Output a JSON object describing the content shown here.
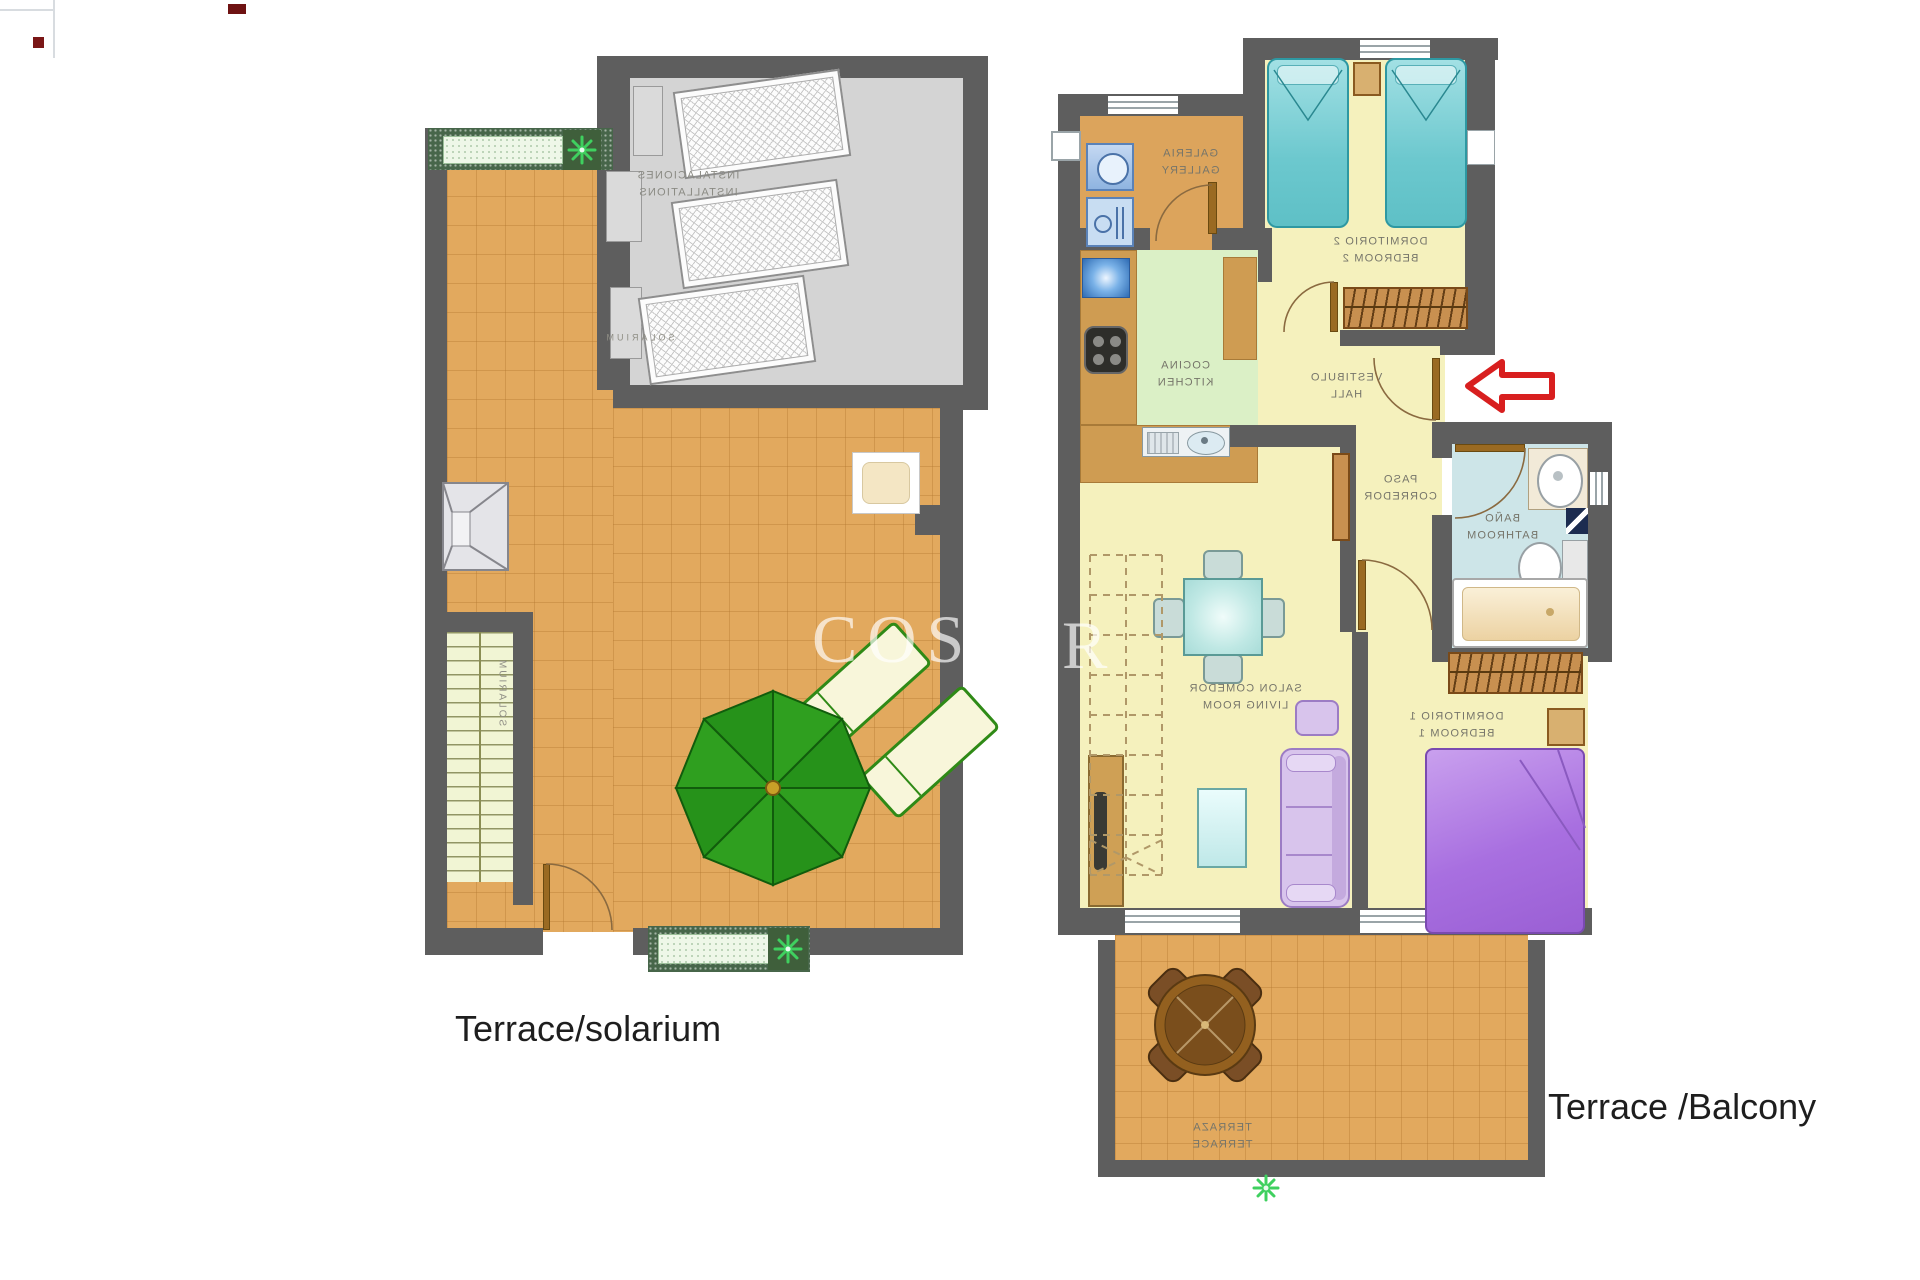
{
  "image": {
    "kind": "real-estate floor plan brochure",
    "background": "#ffffff"
  },
  "watermark": {
    "text": "COST",
    "partial_letter": "R"
  },
  "captions": {
    "left": "Terrace/solarium",
    "right": "Terrace /Balcony"
  },
  "plans": {
    "left": {
      "labels": {
        "installations_es": "INSTALACIONES",
        "installations_en": "INSTALLATIONS",
        "solarium_top": "SOLARIUM",
        "solarium_side": "SOLARIUM"
      }
    },
    "right": {
      "rooms": [
        {
          "id": "gallery",
          "es": "GALERIA",
          "en": "GALLERY"
        },
        {
          "id": "bedroom-2",
          "es": "DORMITORIO 2",
          "en": "BEDROOM 2"
        },
        {
          "id": "kitchen",
          "es": "COCINA",
          "en": "KITCHEN"
        },
        {
          "id": "hall",
          "es": "VESTIBULO",
          "en": "HALL"
        },
        {
          "id": "corridor",
          "es": "PASO",
          "en": "CORREDOR"
        },
        {
          "id": "bathroom",
          "es": "BAÑO",
          "en": "BATHROOM"
        },
        {
          "id": "living-room",
          "es": "SALON COMEDOR",
          "en": "LIVING ROOM"
        },
        {
          "id": "bedroom-1",
          "es": "DORMITORIO 1",
          "en": "BEDROOM 1"
        },
        {
          "id": "terrace",
          "es": "TERRAZA",
          "en": "TERRACE"
        }
      ]
    }
  },
  "icons": {
    "entrance_arrow": "left-arrow",
    "plant": "star-plant",
    "umbrella": "parasol-top-view"
  },
  "colors": {
    "wall": "#5e5e5e",
    "terrace_tile": "#e2a95e",
    "room_yellow": "#f5f1bd",
    "kitchen_green": "#dbf0c6",
    "bathroom_blue": "#cde5e8",
    "installations_gray": "#d4d4d4",
    "umbrella_green": "#2f9f1f",
    "bed_teal": "#6cc8ce",
    "bed_purple": "#a86fe0",
    "sofa_lavender": "#d8c4ec",
    "arrow_red": "#d81f1f"
  }
}
